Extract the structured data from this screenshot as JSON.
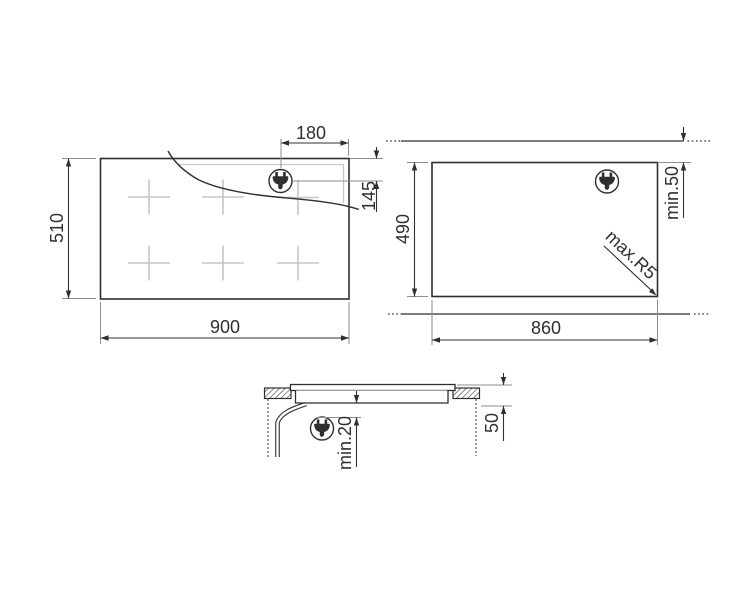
{
  "colors": {
    "line": "#2f2f2f",
    "extension": "#8e8e8e",
    "light_detail": "#c6c6c6",
    "background": "#ffffff"
  },
  "views": {
    "top": {
      "name": "hob-top-view",
      "dims": {
        "width": "900",
        "height": "510",
        "plug_from_right_edge": "180",
        "plug_below_top_edge": "145"
      },
      "icons": {
        "plug": "power-plug-icon"
      }
    },
    "cutout": {
      "name": "worktop-cutout-view",
      "dims": {
        "width": "860",
        "height": "490",
        "rear_clearance": "min.50",
        "corner_radius": "max.R5"
      },
      "icons": {
        "plug": "power-plug-icon"
      }
    },
    "section": {
      "name": "side-section-view",
      "dims": {
        "clearance_below": "min.20",
        "recess_depth": "50"
      },
      "icons": {
        "plug": "power-plug-icon"
      }
    }
  }
}
